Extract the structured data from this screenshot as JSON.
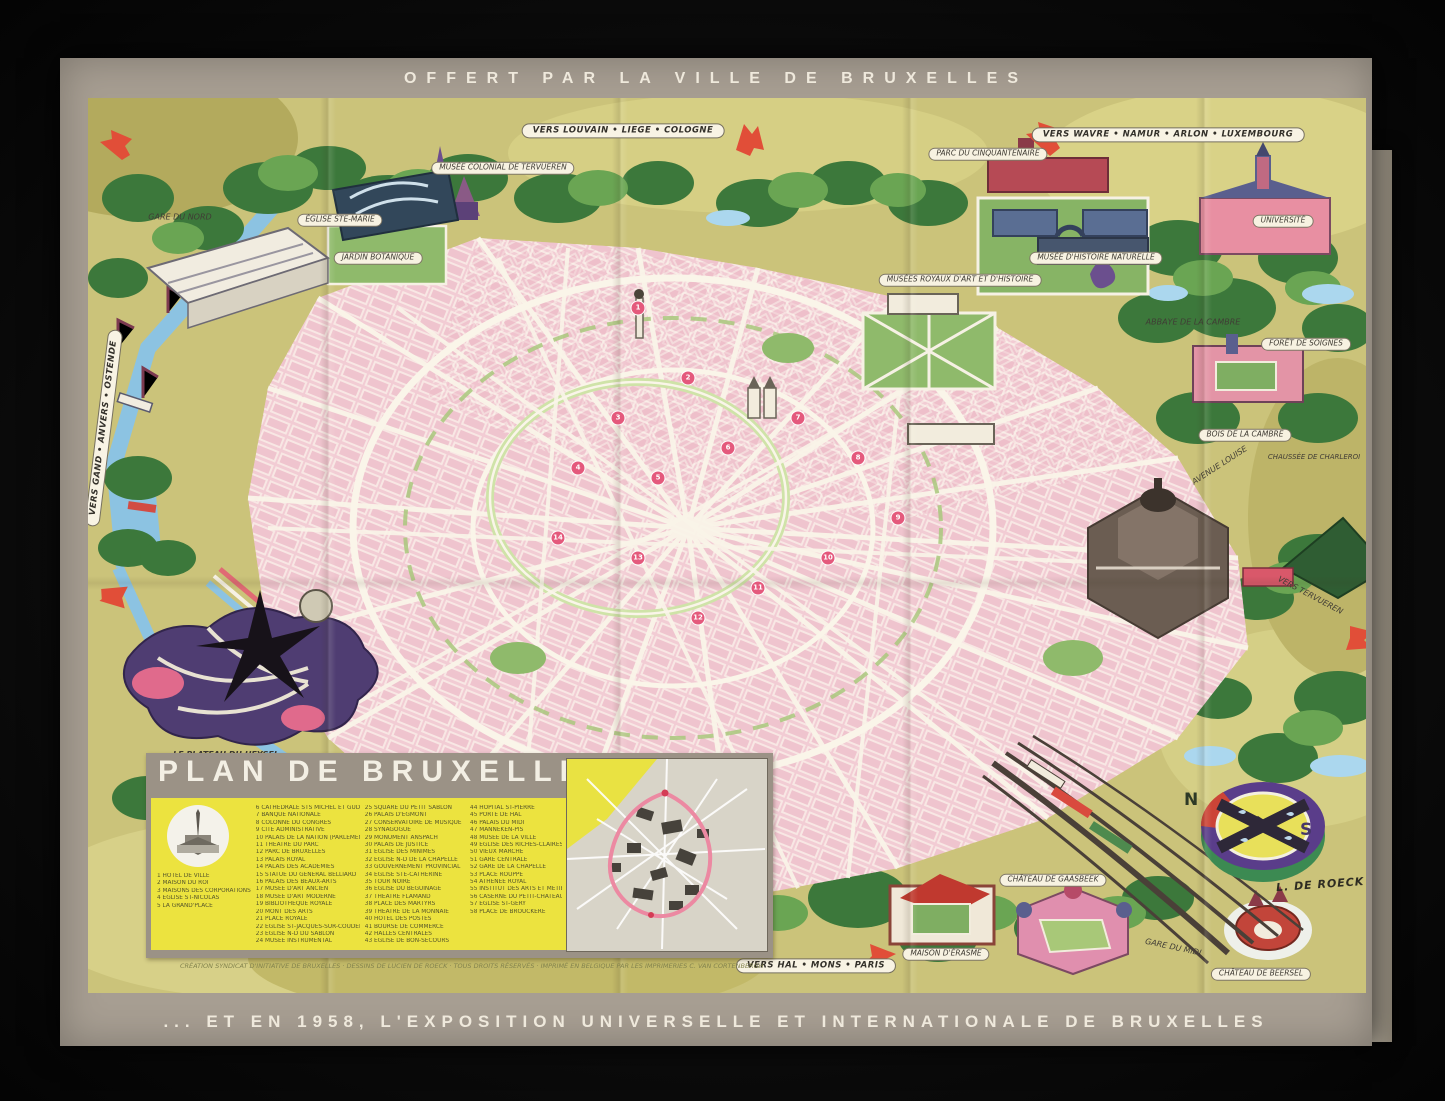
{
  "poster": {
    "top_banner": "OFFERT PAR LA VILLE DE BRUXELLES",
    "bottom_banner": "... ET EN 1958, L'EXPOSITION UNIVERSELLE ET INTERNATIONALE DE BRUXELLES"
  },
  "signs": {
    "louvain": "VERS LOUVAIN • LIEGE • COLOGNE",
    "wavre": "VERS WAVRE • NAMUR • ARLON • LUXEMBOURG",
    "hal": "VERS HAL • MONS • PARIS",
    "gand": "VERS GAND • ANVERS • OSTENDE",
    "tervueren": "VERS TERVUEREN"
  },
  "map_labels": {
    "gare_du_nord": "GARE DU NORD",
    "eglise_ste_marie": "ÉGLISE STE-MARIE",
    "jardin_botanique": "JARDIN BOTANIQUE",
    "musee_colonial": "MUSÉE COLONIAL DE TERVUEREN",
    "cinquantenaire": "PARC DU CINQUANTENAIRE",
    "musees_royaux": "MUSÉES ROYAUX D'ART ET D'HISTOIRE",
    "musee_histoire_naturelle": "MUSÉE D'HISTOIRE NATURELLE",
    "universite": "UNIVERSITÉ",
    "abbaye_cambre": "ABBAYE DE LA CAMBRE",
    "foret_soignes": "FORÊT DE SOIGNES",
    "bois_cambre": "BOIS DE LA CAMBRE",
    "avenue_louise": "AVENUE LOUISE",
    "chaussee_charleroi": "CHAUSSÉE DE CHARLEROI",
    "plateau_heysel": "LE PLATEAU DU HEYSEL",
    "plateau_heysel_sub1": "au cœur des Expositions universelles",
    "plateau_heysel_sub2": "et internationales de Bruxelles en 1958",
    "maison_erasme": "MAISON D'ÉRASME",
    "chateau_gaasbeek": "CHÂTEAU DE GAASBEEK",
    "gare_du_midi": "GARE DU MIDI",
    "chateau_beersel": "CHÂTEAU DE BEERSEL"
  },
  "compass": {
    "north": "N",
    "south": "S"
  },
  "signature": "L. DE ROECK",
  "legend": {
    "title": "PLAN DE BRUXELLES",
    "credits": "CRÉATION SYNDICAT D'INITIATIVE DE BRUXELLES · DESSINS DE LUCIEN DE ROECK · TOUS DROITS RÉSERVÉS · IMPRIMÉ EN BELGIQUE PAR LES IMPRIMERIES C. VAN CORTENBERGH",
    "col1": [
      "1  HÔTEL DE VILLE",
      "2  MAISON DU ROI",
      "3  MAISONS DES CORPORATIONS",
      "4  ÉGLISE ST-NICOLAS",
      "5  LA GRAND'PLACE"
    ],
    "col2": [
      "6  CATHÉDRALE STS MICHEL ET GUDULE",
      "7  BANQUE NATIONALE",
      "8  COLONNE DU CONGRÈS",
      "9  CITÉ ADMINISTRATIVE",
      "10 PALAIS DE LA NATION (PARLEMENT)",
      "11 THÉÂTRE DU PARC",
      "12 PARC DE BRUXELLES",
      "13 PALAIS ROYAL",
      "14 PALAIS DES ACADÉMIES",
      "15 STATUE DU GÉNÉRAL BELLIARD",
      "16 PALAIS DES BEAUX-ARTS",
      "17 MUSÉE D'ART ANCIEN",
      "18 MUSÉE D'ART MODERNE",
      "19 BIBLIOTHÈQUE ROYALE",
      "20 MONT DES ARTS",
      "21 PLACE ROYALE",
      "22 ÉGLISE ST-JACQUES-SUR-COUDENBERG",
      "23 ÉGLISE N-D DU SABLON",
      "24 MUSÉE INSTRUMENTAL"
    ],
    "col3": [
      "25 SQUARE DU PETIT SABLON",
      "26 PALAIS D'EGMONT",
      "27 CONSERVATOIRE DE MUSIQUE",
      "28 SYNAGOGUE",
      "29 MONUMENT ANSPACH",
      "30 PALAIS DE JUSTICE",
      "31 ÉGLISE DES MINIMES",
      "32 ÉGLISE N-D DE LA CHAPELLE",
      "33 GOUVERNEMENT PROVINCIAL",
      "34 ÉGLISE STE-CATHERINE",
      "35 TOUR NOIRE",
      "36 ÉGLISE DU BÉGUINAGE",
      "37 THÉÂTRE FLAMAND",
      "38 PLACE DES MARTYRS",
      "39 THÉÂTRE DE LA MONNAIE",
      "40 HÔTEL DES POSTES",
      "41 BOURSE DE COMMERCE",
      "42 HALLES CENTRALES",
      "43 ÉGLISE DE BON-SECOURS"
    ],
    "col4": [
      "44 HÔPITAL ST-PIERRE",
      "45 PORTE DE HAL",
      "46 PALAIS DU MIDI",
      "47 MANNEKEN-PIS",
      "48 MUSÉE DE LA VILLE",
      "49 ÉGLISE DES RICHES-CLAIRES",
      "50 VIEUX MARCHÉ",
      "51 GARE CENTRALE",
      "52 GARE DE LA CHAPELLE",
      "53 PLACE ROUPPE",
      "54 ATHÉNÉE ROYAL",
      "55 INSTITUT DES ARTS ET MÉTIERS",
      "56 CASERNE DU PETIT-CHÂTEAU",
      "57 ÉGLISE ST-GÉRY",
      "58 PLACE DE BROUCKÈRE"
    ]
  },
  "markers": [
    {
      "n": "1",
      "x": 550,
      "y": 210
    },
    {
      "n": "2",
      "x": 600,
      "y": 280
    },
    {
      "n": "3",
      "x": 530,
      "y": 320
    },
    {
      "n": "4",
      "x": 490,
      "y": 370
    },
    {
      "n": "5",
      "x": 570,
      "y": 380
    },
    {
      "n": "6",
      "x": 640,
      "y": 350
    },
    {
      "n": "7",
      "x": 710,
      "y": 320
    },
    {
      "n": "8",
      "x": 770,
      "y": 360
    },
    {
      "n": "9",
      "x": 810,
      "y": 420
    },
    {
      "n": "10",
      "x": 740,
      "y": 460
    },
    {
      "n": "11",
      "x": 670,
      "y": 490
    },
    {
      "n": "12",
      "x": 610,
      "y": 520
    },
    {
      "n": "13",
      "x": 550,
      "y": 460
    },
    {
      "n": "14",
      "x": 470,
      "y": 440
    }
  ]
}
